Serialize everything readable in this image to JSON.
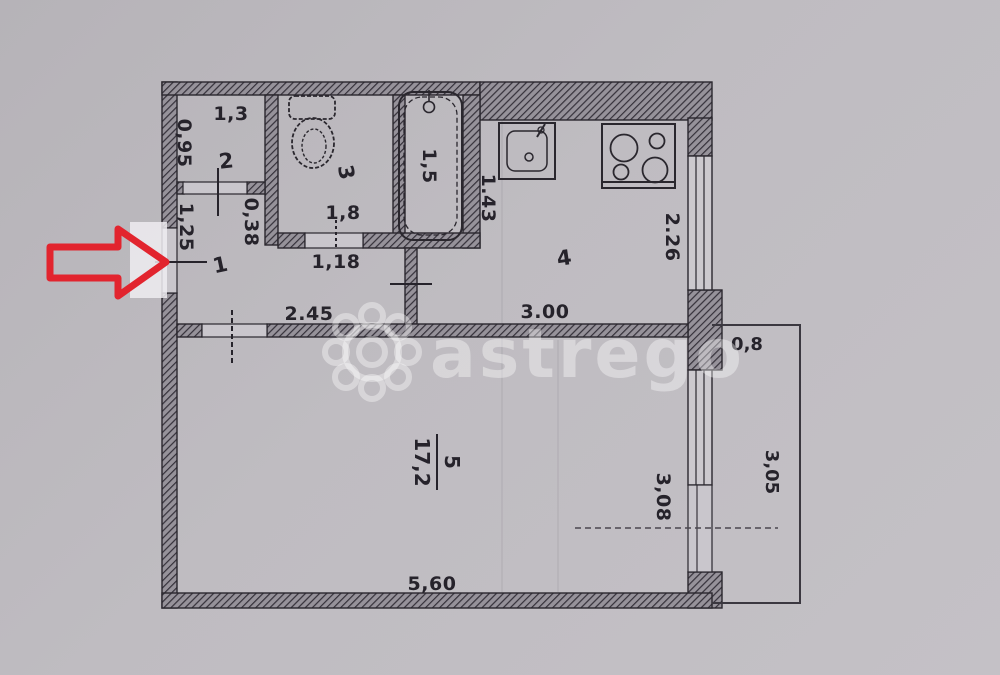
{
  "colors": {
    "paper": "#bdbac0",
    "ink": "#26232b",
    "wall_hatch": "#8e8a92",
    "arrow_red": "#e2242e",
    "watermark": "#d9d6db"
  },
  "watermark": {
    "text": "astrego"
  },
  "rooms": [
    {
      "number": "1"
    },
    {
      "number": "2"
    },
    {
      "number": "3"
    },
    {
      "number": "4"
    },
    {
      "number": "5",
      "area": "17,2"
    }
  ],
  "dims": {
    "room2_width": "1,3",
    "room2_depth": "0,95",
    "entrance_door": "1,25",
    "room2_offset": "0,38",
    "room3_width": "1,8",
    "room3_door": "1,18",
    "bathtub": "1,5",
    "kitchen_left": "1.43",
    "kitchen_right": "2.26",
    "hall_width": "2.45",
    "kitchen_width": "3.00",
    "room5_width": "5,60",
    "room5_window": "3,08",
    "balcony_width": "0,8",
    "balcony_length": "3,05"
  }
}
